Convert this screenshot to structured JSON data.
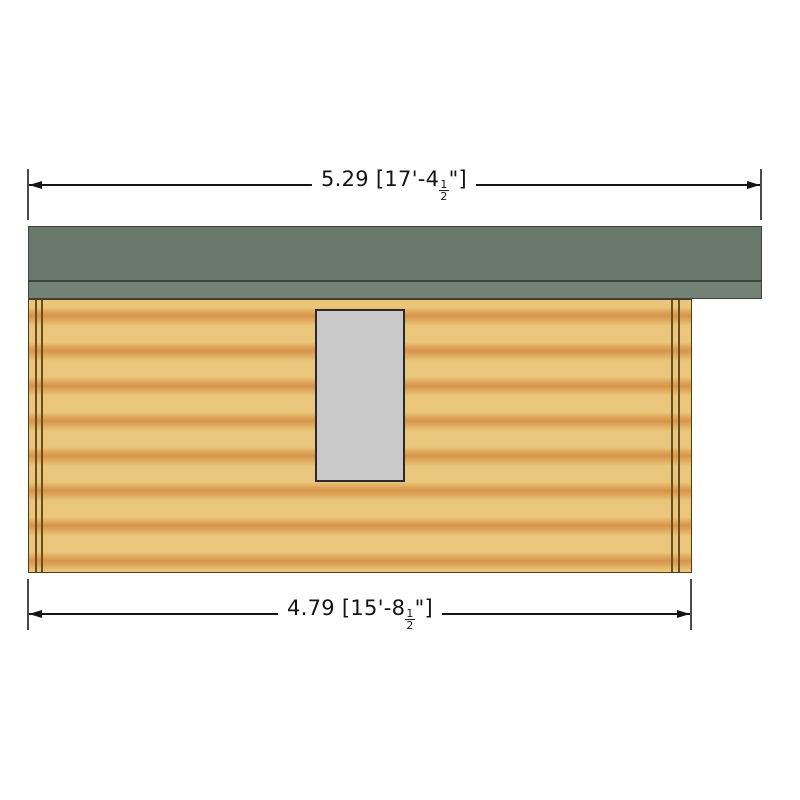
{
  "drawing": {
    "description": "Log cabin side elevation drawing",
    "roof": {
      "surface_color": "#68786b",
      "fascia_color": "#728376",
      "edge_color": "#39453c"
    },
    "wall": {
      "wood_light_color": "#e9c67b",
      "wood_band_color": "#d6944a",
      "outline_color": "#503d18",
      "corner_post_color": "#6a4e1e"
    },
    "window": {
      "fill_color": "#c9c9c9",
      "border_color": "#2b2b2b"
    }
  },
  "dimensions": {
    "top": {
      "metric": "5.29",
      "imperial_prefix": " [17'-4",
      "fraction_numerator": "1",
      "fraction_denominator": "2",
      "imperial_suffix": "\"]"
    },
    "bottom": {
      "metric": "4.79",
      "imperial_prefix": " [15'-8",
      "fraction_numerator": "1",
      "fraction_denominator": "2",
      "imperial_suffix": "\"]"
    }
  }
}
